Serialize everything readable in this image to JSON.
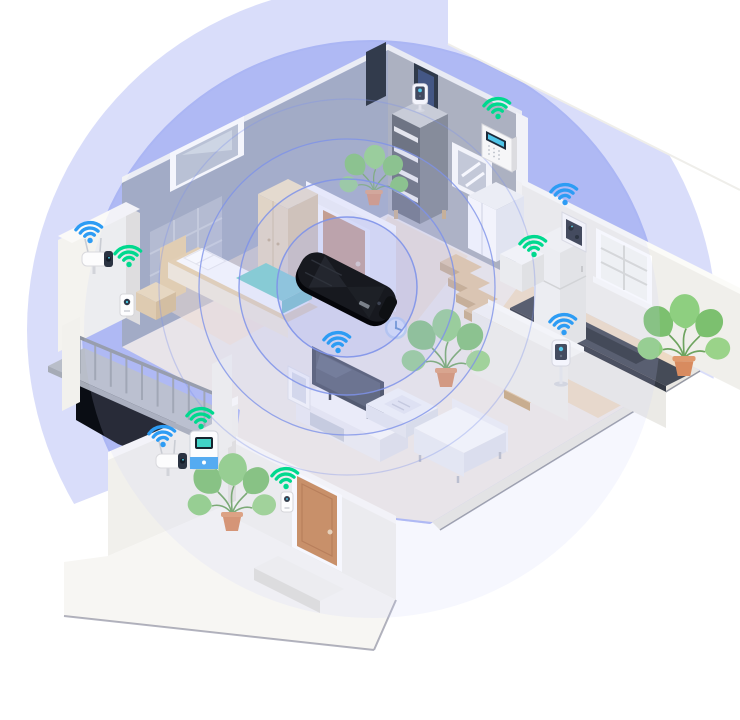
{
  "scene": {
    "description": "Isometric cutaway smart home: black Wi-Fi router lying on the floor at the center, concentric purple coverage rings, and Wi-Fi connected smart devices (cameras, sensors, doorbell, fridge, TV, panel) in every room",
    "background_color": "#FFFFFF",
    "colors": {
      "wifi_blue": "#2D9CF4",
      "wifi_green": "#00D98E",
      "coverage_fill": "#A9B3F3",
      "coverage_outer_fill": "#AAB4F4",
      "ring_stroke": "#7F93EA",
      "ring_fill": "#AAB4F4",
      "stair_top": "#E3C59E",
      "stair_side": "#C9A77D",
      "railing_post": "#9AA0AA",
      "wall_bedroom": "#9BA5BD",
      "wall_gray": "#A7ACB7",
      "wall_white": "#F0EFEB",
      "door_tan": "#C9854F",
      "blanket_teal": "#6ED2C5",
      "plant_green": "#82C477",
      "pot_terracotta": "#D88B5F",
      "router_black": "#17191F",
      "shadow_dark": "#0A0D14"
    },
    "router": {
      "name": "wifi-router",
      "label": "Black Wi-Fi router on the floor at the center of the home",
      "x": 347,
      "y": 287,
      "rotation_deg": 27
    },
    "coverage": {
      "center_x": 347,
      "center_y": 287,
      "ring_radii": [
        70,
        108,
        148,
        188
      ],
      "outer_circle": {
        "cx": 372,
        "cy": 330,
        "r": 290,
        "r_outer": 345
      }
    },
    "devices": [
      {
        "name": "outdoor-camera-balcony",
        "label": "Outdoor security camera on balcony wall",
        "room": "balcony",
        "signal": "blue",
        "wifi": true,
        "x": 96,
        "y": 260,
        "wifi_x": 90,
        "wifi_y": 240
      },
      {
        "name": "motion-sensor",
        "label": "Smart motion sensor on wall edge",
        "room": "bedroom",
        "signal": "green",
        "wifi": true,
        "x": 127,
        "y": 306,
        "wifi_x": 129,
        "wifi_y": 264
      },
      {
        "name": "indoor-camera-shelf",
        "label": "Indoor camera on top of shelf unit",
        "room": "hallway",
        "signal": "none",
        "wifi": false,
        "x": 420,
        "y": 92
      },
      {
        "name": "smart-control-panel",
        "label": "Wall-mounted smart control panel",
        "room": "hallway",
        "signal": "green",
        "wifi": true,
        "x": 497,
        "y": 148,
        "wifi_x": 498,
        "wifi_y": 116
      },
      {
        "name": "outdoor-camera-kitchen",
        "label": "Security camera on kitchen wall corner",
        "room": "kitchen",
        "signal": "blue",
        "wifi": true,
        "x": 574,
        "y": 231,
        "wifi_x": 565,
        "wifi_y": 202
      },
      {
        "name": "smart-refrigerator",
        "label": "Smart refrigerator",
        "room": "kitchen",
        "signal": "green",
        "wifi": true,
        "x": 560,
        "y": 295,
        "wifi_x": 534,
        "wifi_y": 254
      },
      {
        "name": "indoor-camera-ledge",
        "label": "Indoor camera on stand by stair ledge",
        "room": "hallway",
        "signal": "blue",
        "wifi": true,
        "x": 561,
        "y": 353,
        "wifi_x": 564,
        "wifi_y": 332
      },
      {
        "name": "smart-tv",
        "label": "Smart TV on media stand",
        "room": "living-room",
        "signal": "blue",
        "wifi": true,
        "x": 348,
        "y": 383,
        "wifi_x": 338,
        "wifi_y": 350
      },
      {
        "name": "wall-clock",
        "label": "Round wall clock",
        "room": "living-room",
        "signal": "none",
        "wifi": false,
        "x": 396,
        "y": 328
      },
      {
        "name": "video-doorbell",
        "label": "Video doorbell beside front door",
        "room": "entry",
        "signal": "green",
        "wifi": true,
        "x": 287,
        "y": 502,
        "wifi_x": 286,
        "wifi_y": 486
      },
      {
        "name": "outdoor-camera-entry",
        "label": "Outdoor camera on entry wall",
        "room": "entry",
        "signal": "blue",
        "wifi": true,
        "x": 170,
        "y": 462,
        "wifi_x": 163,
        "wifi_y": 444
      },
      {
        "name": "smart-doorbell-station",
        "label": "Smart doorbell station with screen",
        "room": "entry",
        "signal": "green",
        "wifi": true,
        "x": 204,
        "y": 450,
        "wifi_x": 201,
        "wifi_y": 426
      }
    ],
    "stairs": {
      "x": 456,
      "y": 254,
      "dx": 8,
      "dy": 16,
      "count": 9
    },
    "balcony_railing": {
      "x": 64,
      "y": 331,
      "dx": 15.6,
      "dy": 6.6,
      "count": 11,
      "post_length": 36
    },
    "rooms": [
      "bedroom",
      "hallway",
      "kitchen",
      "living-room",
      "entry",
      "balcony",
      "patio"
    ],
    "furniture": [
      "double-bed",
      "nightstand",
      "wardrobe",
      "picture-frames",
      "shelf-unit",
      "sideboard-cabinet",
      "kitchen-counter",
      "refrigerator",
      "kitchen-window",
      "stairs",
      "ledge-wall",
      "tv",
      "tv-stand",
      "coffee-table",
      "sofa",
      "wall-clock",
      "front-door",
      "interior-door",
      "door-step",
      "balcony-railing",
      "potted-plants"
    ]
  }
}
